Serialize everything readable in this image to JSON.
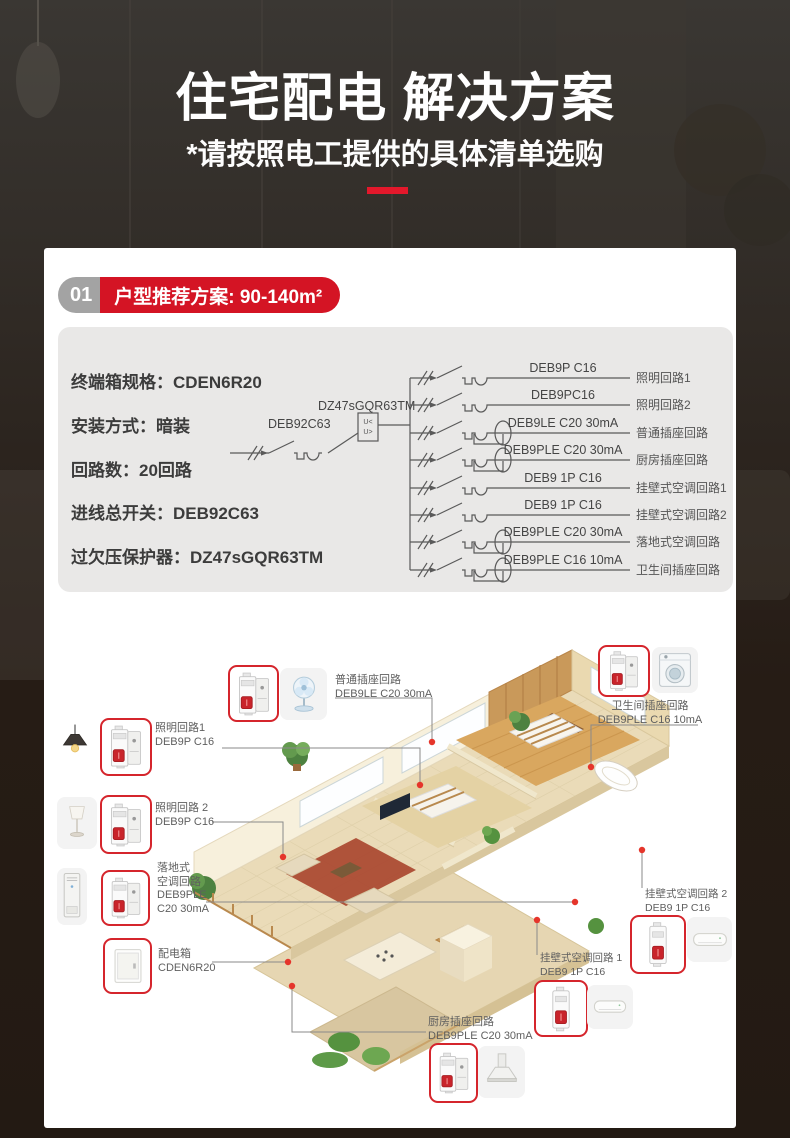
{
  "hero": {
    "title": "住宅配电 解决方案",
    "subtitle": "*请按照电工提供的具体清单选购"
  },
  "section": {
    "number": "01",
    "title": "户型推荐方案: 90-140m²"
  },
  "specs": [
    {
      "label": "终端箱规格：",
      "value": "CDEN6R20"
    },
    {
      "label": "安装方式：",
      "value": "暗装"
    },
    {
      "label": "回路数：",
      "value": "20回路"
    },
    {
      "label": "进线总开关：",
      "value": "DEB92C63"
    },
    {
      "label": "过欠压保护器：",
      "value": "DZ47sGQR63TM"
    }
  ],
  "diagram": {
    "main_breaker": "DEB92C63",
    "protector": "DZ47sGQR63TM",
    "protector_symbol": {
      "line1": "U<",
      "line2": "U>"
    },
    "branches": [
      {
        "model": "DEB9P C16",
        "name": "照明回路1",
        "rcd": false
      },
      {
        "model": "DEB9PC16",
        "name": "照明回路2",
        "rcd": false
      },
      {
        "model": "DEB9LE C20 30mA",
        "name": "普通插座回路",
        "rcd": true
      },
      {
        "model": "DEB9PLE C20 30mA",
        "name": "厨房插座回路",
        "rcd": true
      },
      {
        "model": "DEB9 1P C16",
        "name": "挂壁式空调回路1",
        "rcd": false
      },
      {
        "model": "DEB9 1P C16",
        "name": "挂壁式空调回路2",
        "rcd": false
      },
      {
        "model": "DEB9PLE C20 30mA",
        "name": "落地式空调回路",
        "rcd": true
      },
      {
        "model": "DEB9PLE C16 10mA",
        "name": "卫生间插座回路",
        "rcd": true
      }
    ]
  },
  "plan": {
    "callouts": {
      "putong": {
        "lines": [
          "普通插座回路",
          "DEB9LE C20 30mA"
        ]
      },
      "weishengjian": {
        "lines": [
          "卫生间插座回路",
          "DEB9PLE C16 10mA"
        ]
      },
      "zhaoming1": {
        "lines": [
          "照明回路1",
          "DEB9P C16"
        ]
      },
      "zhaoming2": {
        "lines": [
          "照明回路 2",
          "DEB9P C16"
        ]
      },
      "luodishi": {
        "lines": [
          "落地式",
          "空调回路",
          "DEB9PLE",
          "C20 30mA"
        ]
      },
      "peidianxiang": {
        "lines": [
          "配电箱",
          "CDEN6R20"
        ]
      },
      "guabi2": {
        "lines": [
          "挂壁式空调回路 2",
          "DEB9 1P C16"
        ]
      },
      "guabi1": {
        "lines": [
          "挂壁式空调回路 1",
          "DEB9 1P C16"
        ]
      },
      "chufang": {
        "lines": [
          "厨房插座回路",
          "DEB9PLE C20 30mA"
        ]
      }
    }
  },
  "colors": {
    "accent_red": "#d41424",
    "badge_gray": "#a3a3a3",
    "panel_gray": "#e9e8e7",
    "breaker_border_red": "#d5252c",
    "dot_red": "#e5352b",
    "hero_dash_red": "#e3182b"
  }
}
